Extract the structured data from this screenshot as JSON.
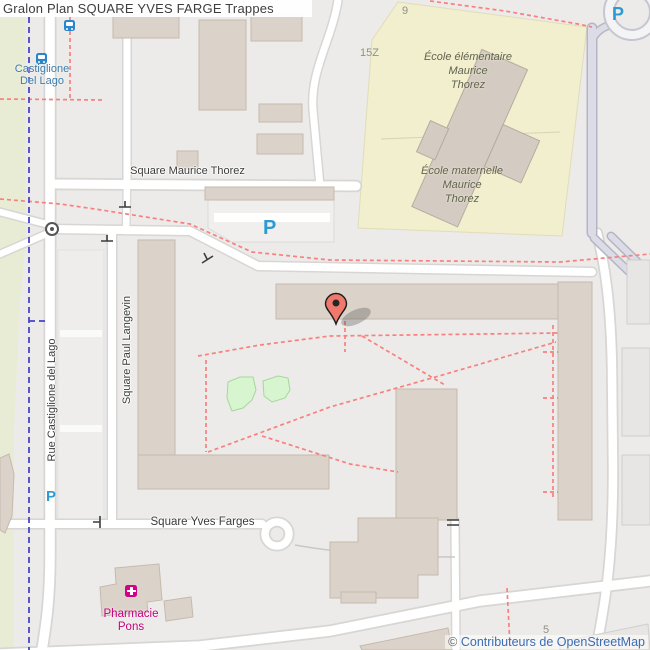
{
  "title": "Gralon Plan SQUARE YVES FARGE Trappes",
  "attribution": {
    "symbol": "©",
    "link_text": "Contributeurs de OpenStreetMap"
  },
  "transit_stop": {
    "line1": "Castiglione",
    "line2": "Del Lago"
  },
  "streets": {
    "maurice_thorez": "Square Maurice Thorez",
    "paul_langevin": "Square Paul Langevin",
    "castiglione_del_lago": "Rue Castiglione del Lago",
    "yves_farges": "Square Yves Farges"
  },
  "pois": {
    "school_elementaire": {
      "line1": "École élémentaire",
      "line2": "Maurice",
      "line3": "Thorez"
    },
    "school_maternelle": {
      "line1": "École maternelle",
      "line2": "Maurice",
      "line3": "Thorez"
    },
    "pharmacy": {
      "line1": "Pharmacie",
      "line2": "Pons"
    }
  },
  "house_numbers": {
    "n9": "9",
    "n15z": "15Z",
    "n5": "5"
  },
  "parking_letter": "P",
  "colors": {
    "background": "#ecebe9",
    "road": "#ffffff",
    "road_casing": "#d7d6d4",
    "pedestrian_road": "#dcdce6",
    "building": "#dbd3ca",
    "school_ground": "#f1efcd",
    "grass_strip": "#e9ecd4",
    "green_area": "#d7f6cf",
    "footpath_dashed": "#f8807f",
    "route_dashed_blue": "#4646c8",
    "pin": "#f0786d",
    "parking_blue": "#2d9ad2",
    "transit_blue": "#3b7cab",
    "pharmacy_magenta": "#c2007b",
    "attribution_blue": "#3b6cb4"
  }
}
